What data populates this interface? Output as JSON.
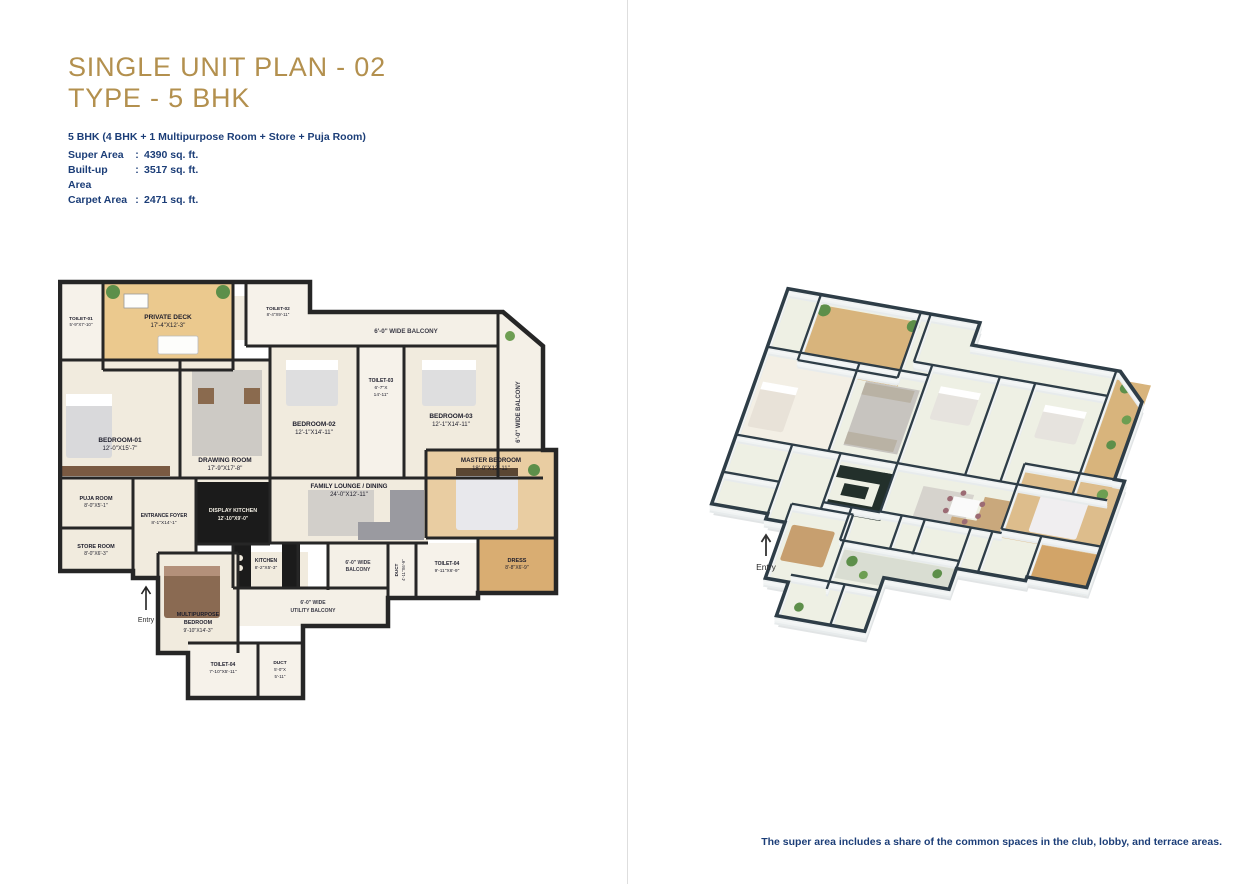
{
  "header": {
    "title_line1": "SINGLE UNIT PLAN - 02",
    "title_line2": "TYPE - 5 BHK",
    "subtitle": "5 BHK (4 BHK + 1 Multipurpose Room + Store + Puja Room)",
    "colon": ":",
    "areas": [
      {
        "label": "Super Area",
        "value": "4390 sq. ft."
      },
      {
        "label": "Built-up Area",
        "value": "3517 sq. ft."
      },
      {
        "label": "Carpet Area",
        "value": "2471 sq. ft."
      }
    ]
  },
  "footnote": "The super area includes a share of the common spaces in the club, lobby, and terrace areas.",
  "colors": {
    "title_gold": "#b3904e",
    "text_navy": "#1c3e78",
    "plan_wall": "#262626",
    "iso_wall_top": "#2e3d47",
    "floor_cream": "#f1ebde",
    "deck_wood": "#ebc98e",
    "plant_green": "#5d8f4a"
  },
  "plan2d": {
    "entry": "Entry",
    "rooms": {
      "toilet1": {
        "name": "TOILET-01",
        "dims": "5'-9''X7'-10''"
      },
      "deck": {
        "name": "PRIVATE DECK",
        "dims": "17'-4''X12'-3''"
      },
      "toilet2": {
        "name": "TOILET-02",
        "dims": "8'-4''X9'-11''"
      },
      "balcony_top": {
        "name": "6'-0'' WIDE BALCONY"
      },
      "balcony_right": {
        "name": "6'-0'' WIDE BALCONY"
      },
      "bedroom1": {
        "name": "BEDROOM-01",
        "dims": "12'-0''X15'-7''"
      },
      "drawing": {
        "name": "DRAWING ROOM",
        "dims": "17'-9''X17'-8''"
      },
      "bedroom2": {
        "name": "BEDROOM-02",
        "dims": "12'-1''X14'-11''"
      },
      "toilet3": {
        "name": "TOILET-03",
        "dims_l1": "6'-7''X",
        "dims_l2": "14'-11''"
      },
      "bedroom3": {
        "name": "BEDROOM-03",
        "dims": "12'-1''X14'-11''"
      },
      "family": {
        "name": "FAMILY LOUNGE / DINING",
        "dims": "24'-0''X12'-11''"
      },
      "master": {
        "name": "MASTER BEDROOM",
        "dims": "18'-0''X12'-11''"
      },
      "puja": {
        "name": "PUJA ROOM",
        "dims": "8'-0''X5'-1''"
      },
      "store": {
        "name": "STORE ROOM",
        "dims": "8'-0''X6'-3''"
      },
      "foyer": {
        "name": "ENTRANCE FOYER",
        "dims": "8'-1''X14'-1''"
      },
      "display_kitchen": {
        "name": "DISPLAY KITCHEN",
        "dims": "12'-10''X9'-0''"
      },
      "kitchen": {
        "name": "KITCHEN",
        "dims": "8'-2''X5'-3''"
      },
      "balcony_bottom": {
        "name_l1": "6'-0'' WIDE",
        "name_l2": "BALCONY"
      },
      "duct1": {
        "name": "DUCT",
        "dims": "4'-11''X6'-9''"
      },
      "toilet4": {
        "name": "TOILET-04",
        "dims": "9'-11''X6'-9''"
      },
      "dress": {
        "name": "DRESS",
        "dims": "8'-8''X6'-9''"
      },
      "multipurpose": {
        "name_l1": "MULTIPURPOSE",
        "name_l2": "BEDROOM",
        "dims": "9'-10''X14'-3''"
      },
      "utility": {
        "name_l1": "6'-0'' WIDE",
        "name_l2": "UTILITY BALCONY"
      },
      "toilet5": {
        "name": "TOILET-04",
        "dims": "7'-10''X5'-11''"
      },
      "duct2": {
        "name": "DUCT",
        "dims_l1": "5'-0''X",
        "dims_l2": "5'-11''"
      }
    }
  },
  "plan3d": {
    "entry": "Entry"
  }
}
